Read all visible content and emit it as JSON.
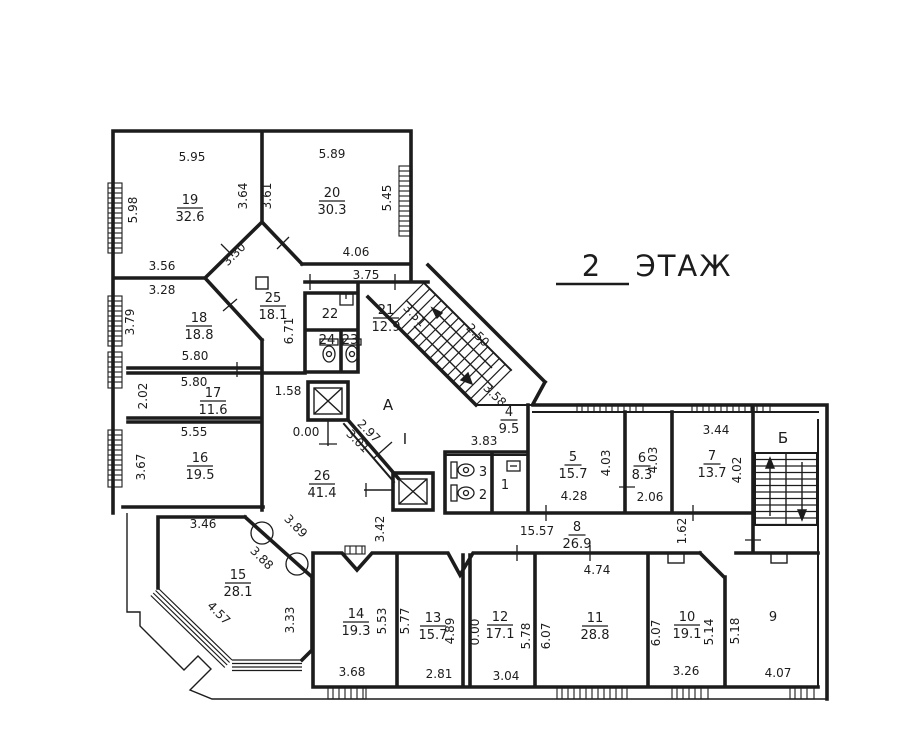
{
  "title": {
    "floor_number": "2",
    "floor_label": "ЭТАЖ"
  },
  "colors": {
    "ink": "#1c1c1c",
    "paper": "#ffffff"
  },
  "rooms": [
    {
      "number": "19",
      "area": "32.6",
      "x": 190,
      "y": 207
    },
    {
      "number": "20",
      "area": "30.3",
      "x": 332,
      "y": 200
    },
    {
      "number": "18",
      "area": "18.8",
      "x": 199,
      "y": 325
    },
    {
      "number": "25",
      "area": "18.1",
      "x": 273,
      "y": 305
    },
    {
      "number": "17",
      "area": "11.6",
      "x": 213,
      "y": 400
    },
    {
      "number": "16",
      "area": "19.5",
      "x": 200,
      "y": 465
    },
    {
      "number": "26",
      "area": "41.4",
      "x": 322,
      "y": 483
    },
    {
      "number": "15",
      "area": "28.1",
      "x": 238,
      "y": 582
    },
    {
      "number": "21",
      "area": "12.9",
      "x": 386,
      "y": 317
    },
    {
      "number": "4",
      "area": "9.5",
      "x": 509,
      "y": 419
    },
    {
      "number": "5",
      "area": "15.7",
      "x": 573,
      "y": 464
    },
    {
      "number": "6",
      "area": "8.3",
      "x": 642,
      "y": 465
    },
    {
      "number": "7",
      "area": "13.7",
      "x": 712,
      "y": 463
    },
    {
      "number": "8",
      "area": "26.9",
      "x": 577,
      "y": 534
    },
    {
      "number": "14",
      "area": "19.3",
      "x": 356,
      "y": 621
    },
    {
      "number": "13",
      "area": "15.7",
      "x": 433,
      "y": 625
    },
    {
      "number": "12",
      "area": "17.1",
      "x": 500,
      "y": 624
    },
    {
      "number": "11",
      "area": "28.8",
      "x": 595,
      "y": 625
    },
    {
      "number": "10",
      "area": "19.1",
      "x": 687,
      "y": 624
    }
  ],
  "room_numbers": [
    {
      "text": "9",
      "x": 773,
      "y": 621
    },
    {
      "text": "22",
      "x": 330,
      "y": 318
    },
    {
      "text": "24",
      "x": 327,
      "y": 344
    },
    {
      "text": "23",
      "x": 350,
      "y": 344
    },
    {
      "text": "3",
      "x": 483,
      "y": 476
    },
    {
      "text": "2",
      "x": 483,
      "y": 499
    },
    {
      "text": "1",
      "x": 505,
      "y": 489
    }
  ],
  "zone_labels": [
    {
      "text": "А",
      "x": 388,
      "y": 410
    },
    {
      "text": "Б",
      "x": 783,
      "y": 443
    },
    {
      "text": "I",
      "x": 405,
      "y": 444
    }
  ],
  "dimensions": [
    {
      "text": "5.95",
      "x": 192,
      "y": 161,
      "rot": 0
    },
    {
      "text": "5.89",
      "x": 332,
      "y": 158,
      "rot": 0
    },
    {
      "text": "5.98",
      "x": 137,
      "y": 210,
      "rot": -90
    },
    {
      "text": "3.64",
      "x": 247,
      "y": 196,
      "rot": -90
    },
    {
      "text": "3.61",
      "x": 271,
      "y": 196,
      "rot": -90
    },
    {
      "text": "5.45",
      "x": 391,
      "y": 198,
      "rot": -90
    },
    {
      "text": "3.56",
      "x": 162,
      "y": 270,
      "rot": 0
    },
    {
      "text": "3.28",
      "x": 162,
      "y": 294,
      "rot": 0
    },
    {
      "text": "3.30",
      "x": 237,
      "y": 257,
      "rot": -45
    },
    {
      "text": "4.06",
      "x": 356,
      "y": 256,
      "rot": 0
    },
    {
      "text": "3.75",
      "x": 366,
      "y": 279,
      "rot": 0
    },
    {
      "text": "3.79",
      "x": 134,
      "y": 322,
      "rot": -90
    },
    {
      "text": "5.80",
      "x": 195,
      "y": 360,
      "rot": 0
    },
    {
      "text": "5.80",
      "x": 194,
      "y": 386,
      "rot": 0
    },
    {
      "text": "2.02",
      "x": 147,
      "y": 396,
      "rot": -90
    },
    {
      "text": "5.55",
      "x": 194,
      "y": 436,
      "rot": 0
    },
    {
      "text": "3.67",
      "x": 145,
      "y": 467,
      "rot": -90
    },
    {
      "text": "6.71",
      "x": 293,
      "y": 331,
      "rot": -90
    },
    {
      "text": "1.58",
      "x": 288,
      "y": 395,
      "rot": 0
    },
    {
      "text": "0.00",
      "x": 306,
      "y": 436,
      "rot": 0
    },
    {
      "text": "3.51",
      "x": 412,
      "y": 318,
      "rot": 45
    },
    {
      "text": "2.50",
      "x": 475,
      "y": 338,
      "rot": 45
    },
    {
      "text": "3.58",
      "x": 492,
      "y": 398,
      "rot": 45
    },
    {
      "text": "2.97",
      "x": 366,
      "y": 434,
      "rot": 45
    },
    {
      "text": "3.01",
      "x": 355,
      "y": 444,
      "rot": 45
    },
    {
      "text": "3.83",
      "x": 484,
      "y": 445,
      "rot": 0
    },
    {
      "text": "3.46",
      "x": 203,
      "y": 528,
      "rot": 0
    },
    {
      "text": "3.42",
      "x": 384,
      "y": 529,
      "rot": -90
    },
    {
      "text": "3.89",
      "x": 293,
      "y": 529,
      "rot": 45
    },
    {
      "text": "3.88",
      "x": 259,
      "y": 561,
      "rot": 45
    },
    {
      "text": "4.57",
      "x": 216,
      "y": 616,
      "rot": 45
    },
    {
      "text": "3.33",
      "x": 294,
      "y": 620,
      "rot": -90
    },
    {
      "text": "15.57",
      "x": 537,
      "y": 535,
      "rot": 0
    },
    {
      "text": "1.62",
      "x": 686,
      "y": 531,
      "rot": -90
    },
    {
      "text": "4.28",
      "x": 574,
      "y": 500,
      "rot": 0
    },
    {
      "text": "4.03",
      "x": 610,
      "y": 463,
      "rot": -90
    },
    {
      "text": "4.03",
      "x": 657,
      "y": 460,
      "rot": -90
    },
    {
      "text": "2.06",
      "x": 650,
      "y": 501,
      "rot": 0
    },
    {
      "text": "3.44",
      "x": 716,
      "y": 434,
      "rot": 0
    },
    {
      "text": "4.02",
      "x": 741,
      "y": 470,
      "rot": -90
    },
    {
      "text": "4.74",
      "x": 597,
      "y": 574,
      "rot": 0
    },
    {
      "text": "5.53",
      "x": 386,
      "y": 621,
      "rot": -90
    },
    {
      "text": "5.77",
      "x": 409,
      "y": 621,
      "rot": -90
    },
    {
      "text": "4.89",
      "x": 454,
      "y": 631,
      "rot": -90
    },
    {
      "text": "0.00",
      "x": 479,
      "y": 632,
      "rot": -90
    },
    {
      "text": "5.78",
      "x": 530,
      "y": 636,
      "rot": -90
    },
    {
      "text": "6.07",
      "x": 550,
      "y": 636,
      "rot": -90
    },
    {
      "text": "6.07",
      "x": 660,
      "y": 633,
      "rot": -90
    },
    {
      "text": "5.14",
      "x": 713,
      "y": 632,
      "rot": -90
    },
    {
      "text": "5.18",
      "x": 739,
      "y": 631,
      "rot": -90
    },
    {
      "text": "2.81",
      "x": 439,
      "y": 678,
      "rot": 0
    },
    {
      "text": "3.04",
      "x": 506,
      "y": 680,
      "rot": 0
    },
    {
      "text": "3.68",
      "x": 352,
      "y": 676,
      "rot": 0
    },
    {
      "text": "3.26",
      "x": 686,
      "y": 675,
      "rot": 0
    },
    {
      "text": "4.07",
      "x": 778,
      "y": 677,
      "rot": 0
    }
  ]
}
